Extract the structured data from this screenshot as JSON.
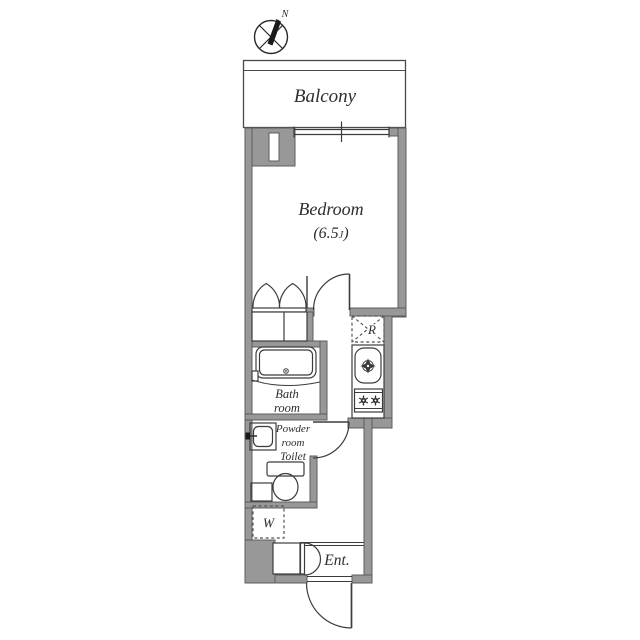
{
  "colors": {
    "wall_fill": "#989898",
    "wall_edge": "#5d5d5d",
    "line": "#3c3c3c",
    "text": "#2e2e2e",
    "background": "#ffffff"
  },
  "compass": {
    "north_label": "N"
  },
  "balcony": {
    "label": "Balcony"
  },
  "bedroom": {
    "label": "Bedroom",
    "size_open": "(6.5",
    "size_unit_small": "J",
    "size_close": ")"
  },
  "bathroom": {
    "line1": "Bath",
    "line2": "room"
  },
  "powder_room": {
    "line1": "Powder",
    "line2": "room",
    "line3": "Toilet"
  },
  "washer_space": {
    "label": "W"
  },
  "refrigerator_space": {
    "label": "R"
  },
  "entrance": {
    "label": "Ent."
  }
}
